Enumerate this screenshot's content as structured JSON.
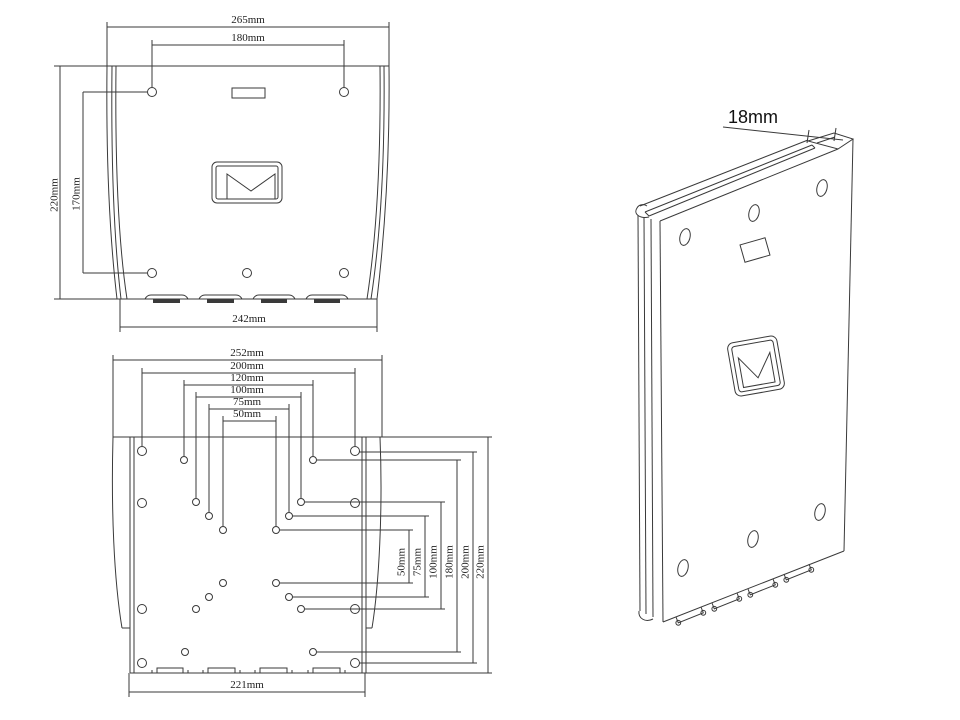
{
  "colors": {
    "line": "#3a3a3a",
    "text": "#1e1e1e",
    "background": "#ffffff"
  },
  "logo": {
    "name": "m-envelope-brand-mark"
  },
  "front": {
    "w265": "265mm",
    "w180": "180mm",
    "h220": "220mm",
    "h170": "170mm",
    "w242": "242mm"
  },
  "vesa": {
    "top": [
      "252mm",
      "200mm",
      "120mm",
      "100mm",
      "75mm",
      "50mm"
    ],
    "right": [
      "50mm",
      "75mm",
      "100mm",
      "180mm",
      "200mm",
      "220mm"
    ],
    "w221": "221mm"
  },
  "iso": {
    "t18": "18mm"
  }
}
